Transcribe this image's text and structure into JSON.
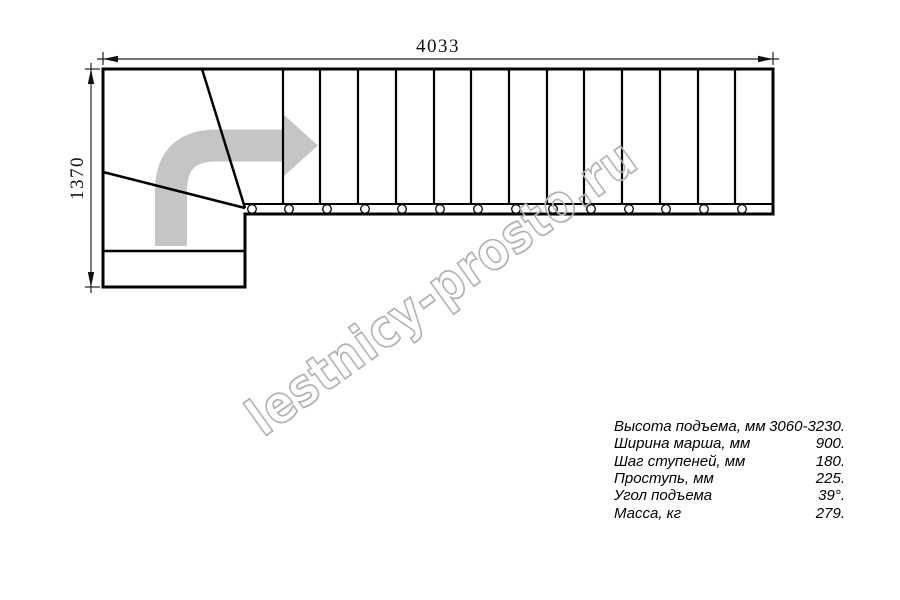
{
  "watermark": {
    "text": "lestnicy-prosto.ru",
    "color": "#b2b2b2"
  },
  "dimensions": {
    "total_run": "4033",
    "total_width": "1370"
  },
  "specs": [
    {
      "label": "Высота подъема, мм",
      "value": "3060-3230."
    },
    {
      "label": "Ширина марша, мм",
      "value": "900."
    },
    {
      "label": "Шаг ступеней, мм",
      "value": "180."
    },
    {
      "label": "Проступь, мм",
      "value": "225."
    },
    {
      "label": "Угол подъема",
      "value": "39°."
    },
    {
      "label": "Масса, кг",
      "value": "279."
    }
  ],
  "drawing": {
    "type": "staircase-plan-top-view",
    "tread_lines": 13,
    "post_circles": 14,
    "winder_steps": 3,
    "direction_arrow_color": "#c5c5c5",
    "line_color": "#000000"
  }
}
